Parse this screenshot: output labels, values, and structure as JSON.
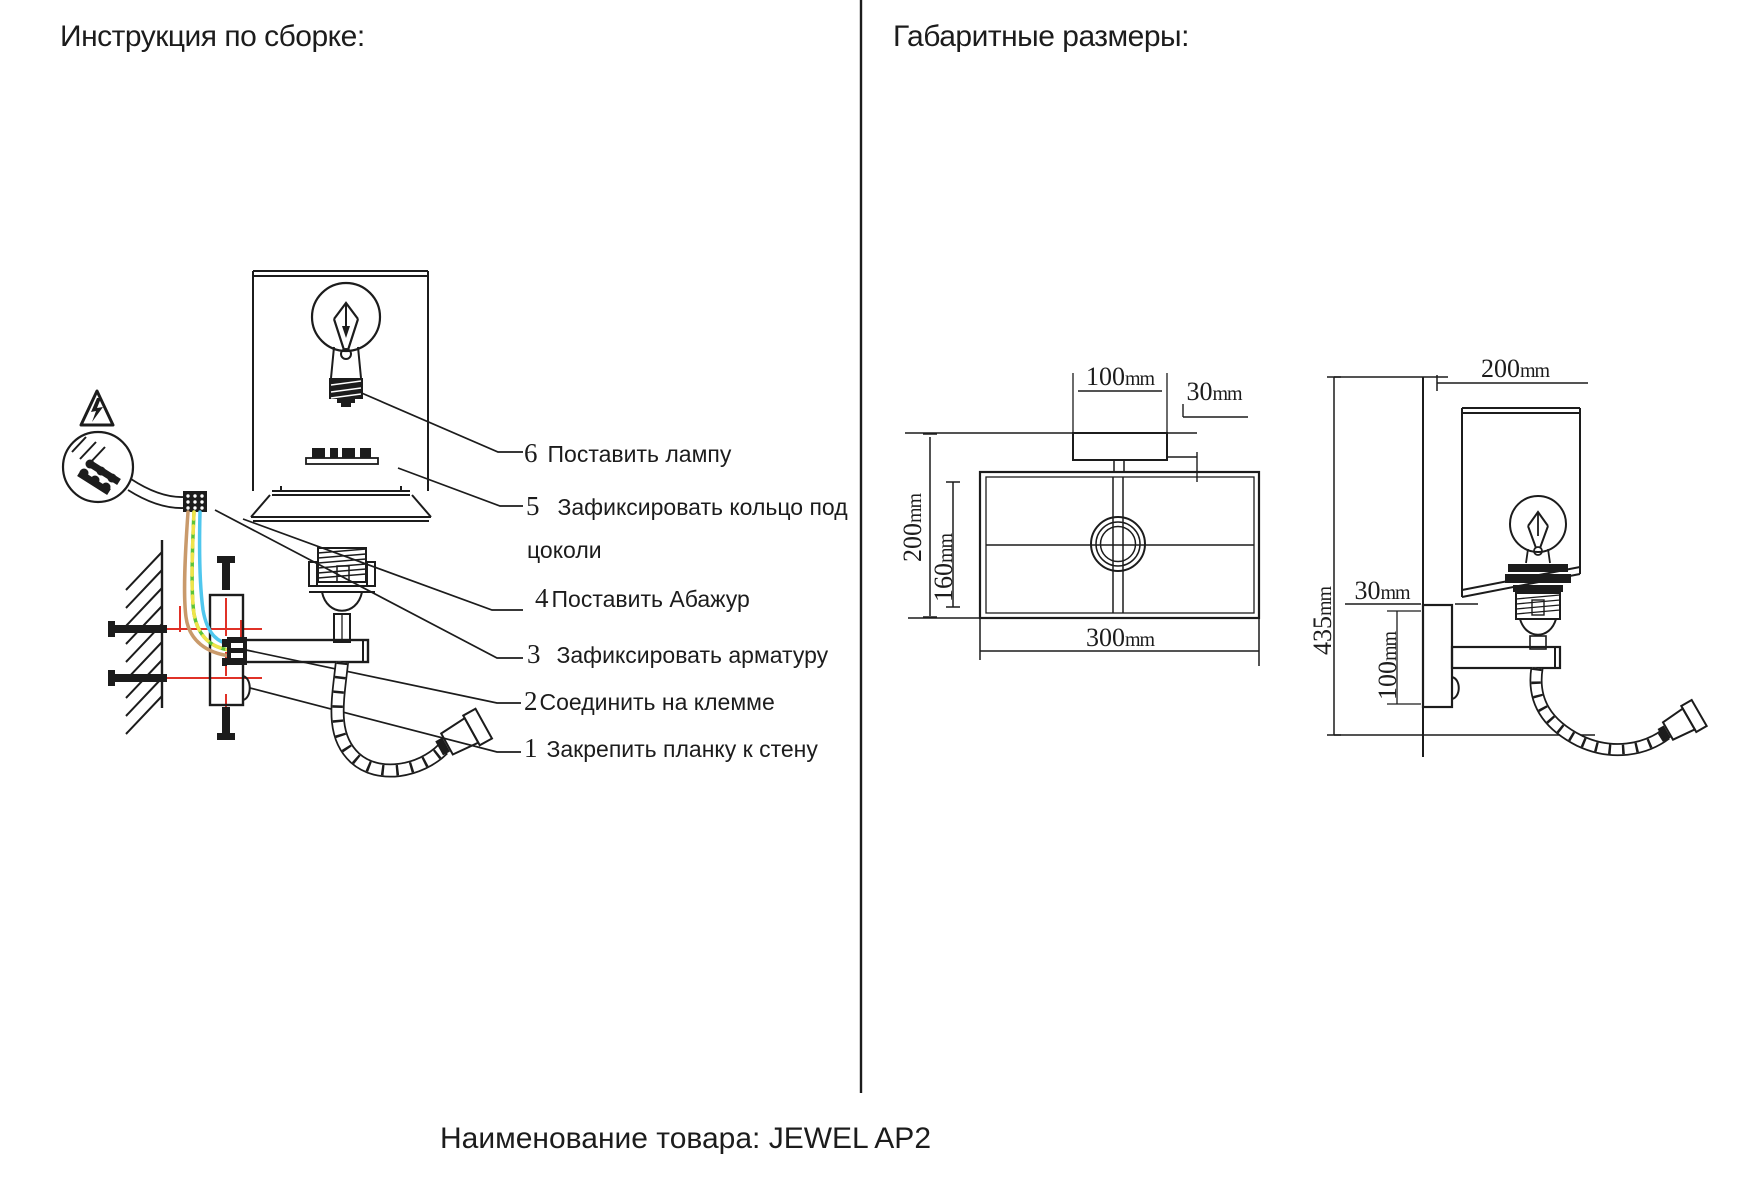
{
  "titles": {
    "left": "Инструкция по сборке:",
    "right": "Габаритные размеры:",
    "footer": "Наименование товара: JEWEL AP2"
  },
  "steps": [
    {
      "num": "6",
      "text": "Поставить лампу"
    },
    {
      "num": "5",
      "text": "Зафиксировать кольцо под",
      "text_wrap": "цоколи"
    },
    {
      "num": "4",
      "text": "Поставить Абажур"
    },
    {
      "num": "3",
      "text": "Зафиксировать арматуру"
    },
    {
      "num": "2",
      "text": "Соединить на клемме"
    },
    {
      "num": "1",
      "text": "Закрепить планку к стену"
    }
  ],
  "dims": {
    "top_view": {
      "plate_width": {
        "value": "100",
        "unit": "mm"
      },
      "offset": {
        "value": "30",
        "unit": "mm"
      },
      "outer_depth": {
        "value": "200",
        "unit": "mm"
      },
      "inner_depth": {
        "value": "160",
        "unit": "mm"
      },
      "shade_width": {
        "value": "300",
        "unit": "mm"
      }
    },
    "side_view": {
      "shade_width": {
        "value": "200",
        "unit": "mm"
      },
      "total_height": {
        "value": "435",
        "unit": "mm"
      },
      "wall_offset": {
        "value": "30",
        "unit": "mm"
      },
      "plate_height": {
        "value": "100",
        "unit": "mm"
      }
    }
  },
  "colors": {
    "line": "#1c1c1c",
    "alignment_red": "#e03127",
    "wire_brown": "#c99a6b",
    "wire_green": "#5dc438",
    "wire_yellow": "#efe44a",
    "wire_blue": "#4fc7ee"
  },
  "icons": [
    "warning-triangle-icon",
    "magnifier-detail"
  ]
}
